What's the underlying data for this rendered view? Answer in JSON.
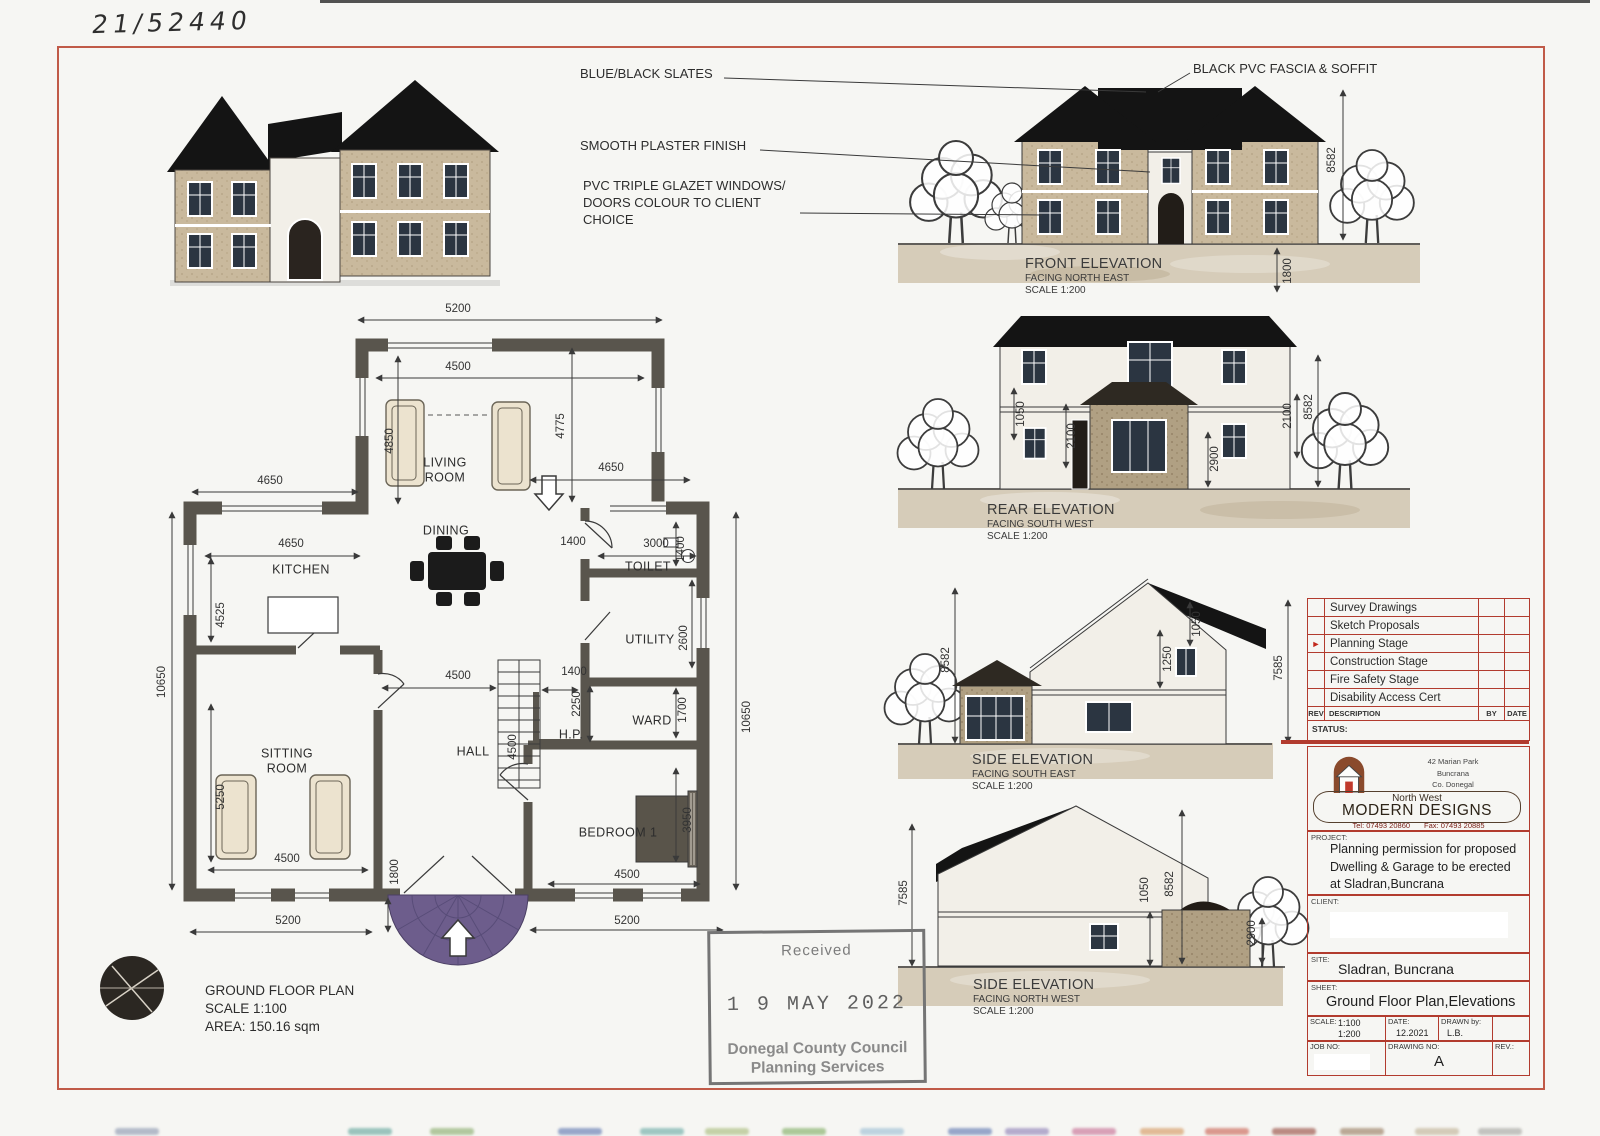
{
  "page": {
    "handwritten_ref": "21/52440"
  },
  "callouts": {
    "slates": "BLUE/BLACK SLATES",
    "plaster": "SMOOTH PLASTER FINISH",
    "windows": "PVC TRIPLE GLAZET WINDOWS/\nDOORS COLOUR TO CLIENT\nCHOICE",
    "fascia": "BLACK PVC FASCIA & SOFFIT"
  },
  "floor_plan": {
    "title": "GROUND FLOOR PLAN",
    "scale": "SCALE 1:100",
    "area": "AREA: 150.16 sqm",
    "rooms": [
      {
        "text": "LIVING\nROOM",
        "x": 445,
        "y": 470
      },
      {
        "text": "DINING",
        "x": 446,
        "y": 531
      },
      {
        "text": "KITCHEN",
        "x": 301,
        "y": 570
      },
      {
        "text": "TOILET",
        "x": 648,
        "y": 567
      },
      {
        "text": "UTILITY",
        "x": 650,
        "y": 640
      },
      {
        "text": "WARD",
        "x": 652,
        "y": 721
      },
      {
        "text": "HALL",
        "x": 473,
        "y": 752
      },
      {
        "text": "H.P.",
        "x": 571,
        "y": 735
      },
      {
        "text": "SITTING\nROOM",
        "x": 287,
        "y": 761
      },
      {
        "text": "BEDROOM 1",
        "x": 618,
        "y": 833
      }
    ],
    "dims": [
      {
        "text": "5200",
        "x": 458,
        "y": 309
      },
      {
        "text": "4500",
        "x": 458,
        "y": 367
      },
      {
        "text": "4850",
        "x": 390,
        "y": 441,
        "rot": "v"
      },
      {
        "text": "4775",
        "x": 561,
        "y": 426,
        "rot": "v"
      },
      {
        "text": "4650",
        "x": 270,
        "y": 481
      },
      {
        "text": "4650",
        "x": 611,
        "y": 468
      },
      {
        "text": "4650",
        "x": 291,
        "y": 544
      },
      {
        "text": "3000",
        "x": 656,
        "y": 544
      },
      {
        "text": "1400",
        "x": 573,
        "y": 542
      },
      {
        "text": "1400",
        "x": 681,
        "y": 549,
        "rot": "v"
      },
      {
        "text": "2600",
        "x": 684,
        "y": 638,
        "rot": "v"
      },
      {
        "text": "1700",
        "x": 683,
        "y": 710,
        "rot": "v"
      },
      {
        "text": "4525",
        "x": 221,
        "y": 615,
        "rot": "v"
      },
      {
        "text": "10650",
        "x": 162,
        "y": 682,
        "rot": "v"
      },
      {
        "text": "10650",
        "x": 747,
        "y": 717,
        "rot": "v"
      },
      {
        "text": "4500",
        "x": 458,
        "y": 676
      },
      {
        "text": "1400",
        "x": 574,
        "y": 672
      },
      {
        "text": "2250",
        "x": 577,
        "y": 704,
        "rot": "v"
      },
      {
        "text": "4500",
        "x": 513,
        "y": 747,
        "rot": "v"
      },
      {
        "text": "5250",
        "x": 221,
        "y": 797,
        "rot": "v"
      },
      {
        "text": "4500",
        "x": 287,
        "y": 859
      },
      {
        "text": "4500",
        "x": 627,
        "y": 875
      },
      {
        "text": "3950",
        "x": 688,
        "y": 820,
        "rot": "v"
      },
      {
        "text": "1800",
        "x": 395,
        "y": 872,
        "rot": "v"
      },
      {
        "text": "5200",
        "x": 288,
        "y": 921
      },
      {
        "text": "5200",
        "x": 627,
        "y": 921
      }
    ]
  },
  "elevations": [
    {
      "name": "FRONT ELEVATION",
      "facing": "FACING NORTH EAST",
      "scale": "SCALE 1:200",
      "dims": [
        {
          "text": "8582",
          "x": 1332,
          "y": 160,
          "rot": "v"
        },
        {
          "text": "1800",
          "x": 1288,
          "y": 271,
          "rot": "v"
        }
      ]
    },
    {
      "name": "REAR ELEVATION",
      "facing": "FACING SOUTH WEST",
      "scale": "SCALE 1:200",
      "dims": [
        {
          "text": "1050",
          "x": 1021,
          "y": 414,
          "rot": "v"
        },
        {
          "text": "2100",
          "x": 1072,
          "y": 436,
          "rot": "v"
        },
        {
          "text": "2100",
          "x": 1288,
          "y": 416,
          "rot": "v"
        },
        {
          "text": "2900",
          "x": 1215,
          "y": 459,
          "rot": "v"
        },
        {
          "text": "8582",
          "x": 1309,
          "y": 407,
          "rot": "v"
        }
      ]
    },
    {
      "name": "SIDE ELEVATION",
      "facing": "FACING SOUTH EAST",
      "scale": "SCALE 1:200",
      "dims": [
        {
          "text": "8582",
          "x": 946,
          "y": 660,
          "rot": "v"
        },
        {
          "text": "1250",
          "x": 1168,
          "y": 659,
          "rot": "v"
        },
        {
          "text": "1050",
          "x": 1197,
          "y": 624,
          "rot": "v"
        },
        {
          "text": "7585",
          "x": 1279,
          "y": 668,
          "rot": "v"
        }
      ]
    },
    {
      "name": "SIDE ELEVATION",
      "facing": "FACING NORTH WEST",
      "scale": "SCALE 1:200",
      "dims": [
        {
          "text": "7585",
          "x": 904,
          "y": 893,
          "rot": "v"
        },
        {
          "text": "1050",
          "x": 1145,
          "y": 890,
          "rot": "v"
        },
        {
          "text": "8582",
          "x": 1170,
          "y": 884,
          "rot": "v"
        },
        {
          "text": "2900",
          "x": 1252,
          "y": 933,
          "rot": "v"
        }
      ]
    }
  ],
  "stamp": {
    "received": "Received",
    "date": "1 9 MAY 2022",
    "org": "Donegal County Council",
    "dept": "Planning Services"
  },
  "title_block": {
    "stages": [
      {
        "label": "Survey Drawings",
        "active": false
      },
      {
        "label": "Sketch Proposals",
        "active": false
      },
      {
        "label": "Planning Stage",
        "active": true
      },
      {
        "label": "Construction Stage",
        "active": false
      },
      {
        "label": "Fire Safety Stage",
        "active": false
      },
      {
        "label": "Disability Access Cert",
        "active": false
      }
    ],
    "marker": "►",
    "rev_header": {
      "rev": "REV",
      "description": "DESCRIPTION",
      "by": "BY",
      "date": "DATE"
    },
    "status_label": "STATUS:",
    "firm": {
      "address1": "42 Marian Park",
      "address2": "Buncrana",
      "address3": "Co. Donegal",
      "name_top": "North West",
      "name": "MODERN DESIGNS",
      "tel": "Tel: 07493 20860",
      "fax": "Fax: 07493 20885"
    },
    "project_label": "PROJECT:",
    "project": "Planning permission for proposed\nDwelling & Garage to be erected\nat Sladran,Buncrana",
    "client_label": "CLIENT:",
    "site_label": "SITE:",
    "site": "Sladran, Buncrana",
    "sheet_label": "SHEET:",
    "sheet": "Ground Floor Plan,Elevations",
    "scale_label": "SCALE:",
    "scale_values": "1:100\n1:200",
    "date_label": "DATE:",
    "date": "12.2021",
    "drawn_label": "DRAWN by:",
    "drawn": "L.B.",
    "job_label": "JOB NO:",
    "drawing_label": "DRAWING NO:",
    "drawing_no": "A",
    "rev_label": "REV.:"
  },
  "colors": {
    "frame_red": "#c05a48",
    "accent_red": "#b23b2e",
    "wall": "#59554d",
    "roof": "#141414",
    "stone": "#c9b99d",
    "entry_mosaic": "#6d5d8c"
  },
  "scan_strip": [
    {
      "x": 115,
      "color": "#7d8aa6"
    },
    {
      "x": 348,
      "color": "#4f9a90"
    },
    {
      "x": 430,
      "color": "#7aa25a"
    },
    {
      "x": 558,
      "color": "#4a66a8"
    },
    {
      "x": 640,
      "color": "#57a09a"
    },
    {
      "x": 705,
      "color": "#9db36a"
    },
    {
      "x": 782,
      "color": "#6fa34e"
    },
    {
      "x": 860,
      "color": "#8fb6cf"
    },
    {
      "x": 948,
      "color": "#4a66a8"
    },
    {
      "x": 1005,
      "color": "#7f6fae"
    },
    {
      "x": 1072,
      "color": "#c05a86"
    },
    {
      "x": 1140,
      "color": "#d08a4a"
    },
    {
      "x": 1205,
      "color": "#c44d3c"
    },
    {
      "x": 1272,
      "color": "#8a3326"
    },
    {
      "x": 1340,
      "color": "#8a6a4a"
    },
    {
      "x": 1415,
      "color": "#b8a888"
    },
    {
      "x": 1478,
      "color": "#9a9a96"
    }
  ]
}
